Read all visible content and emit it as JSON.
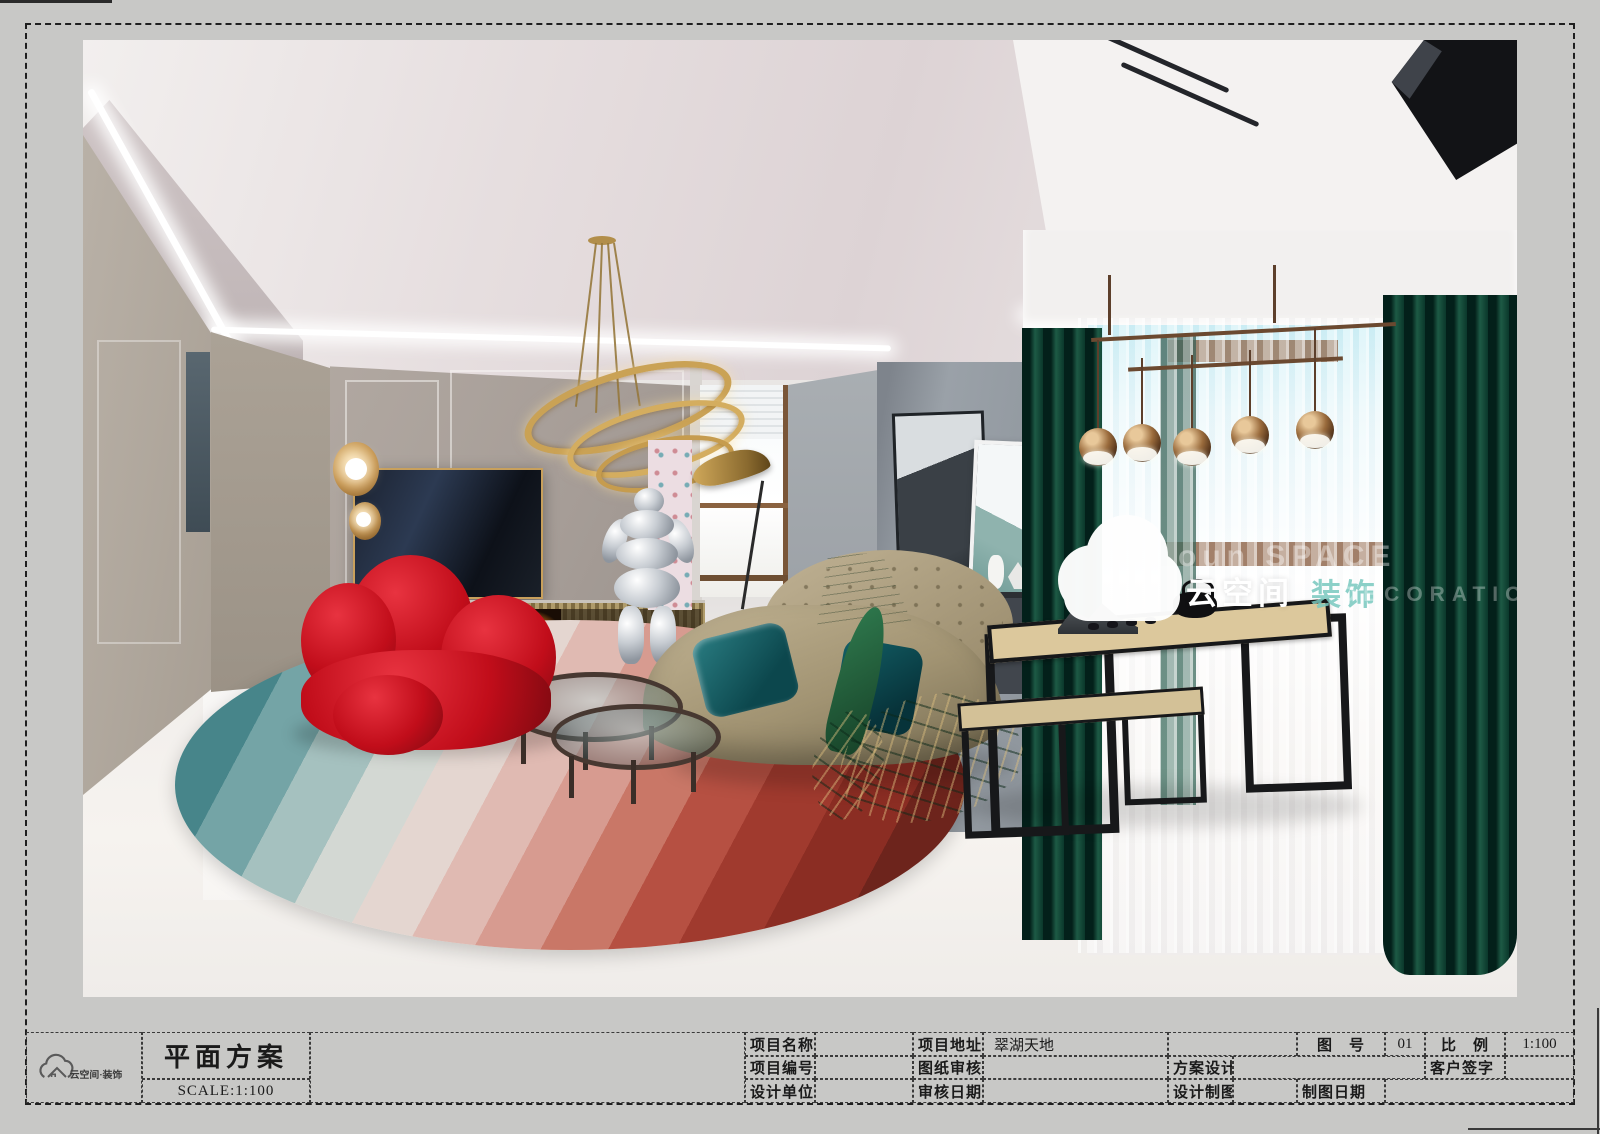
{
  "sheet": {
    "background_color": "#c8c8c6",
    "border_color": "#1f1f1f"
  },
  "title_block": {
    "logo_brand": "云空间·装饰",
    "drawing_title": "平面方案",
    "scale_note": "SCALE:1:100",
    "fields": {
      "project_name_label": "项目名称",
      "project_address_label": "项目地址",
      "project_address_value": "翠湖天地",
      "project_no_label": "项目编号",
      "drawing_review_label": "图纸审核",
      "scheme_design_label": "方案设计",
      "design_unit_label": "设计单位",
      "review_date_label": "审核日期",
      "design_drafting_label": "设计制图",
      "figure_no_label": "图　号",
      "figure_no_value": "01",
      "scale_label": "比　例",
      "scale_value": "1:100",
      "client_signature_label": "客户签字",
      "drafting_date_label": "制图日期"
    }
  },
  "watermark": {
    "icon": "cloud-logo",
    "brand_cn": "云空间",
    "brand_tail_cn": "装饰",
    "ghost_en_1": "oun SPACE",
    "ghost_en_2": "DECORATION"
  },
  "scene": {
    "type": "interior-render",
    "room": "living-room",
    "objects": [
      "tray-ceiling-cove-light",
      "gold-ring-chandelier",
      "wall-sconce",
      "tv",
      "fireplace",
      "red-lounge-chair",
      "gradient-round-rug",
      "glass-coffee-tables",
      "spaceman-sculpture",
      "leaf-floor-lamp",
      "tan-curved-sofa",
      "teal-pillows",
      "green-goose-sculpture",
      "sideboard",
      "wall-art",
      "mirror",
      "tea-table",
      "tea-bench",
      "tea-set",
      "pipe-pendant-lamp",
      "green-velvet-curtains",
      "sheer-curtain",
      "bay-window"
    ],
    "palette": {
      "rug_teal": "#2a6a70",
      "rug_red": "#a03a2e",
      "chair_red": "#c10d1a",
      "sofa_tan": "#a99a78",
      "curtain_green": "#0e4434",
      "gold": "#c9a254",
      "wall_greige": "#aaa29a",
      "floor_white": "#f2efec"
    }
  }
}
